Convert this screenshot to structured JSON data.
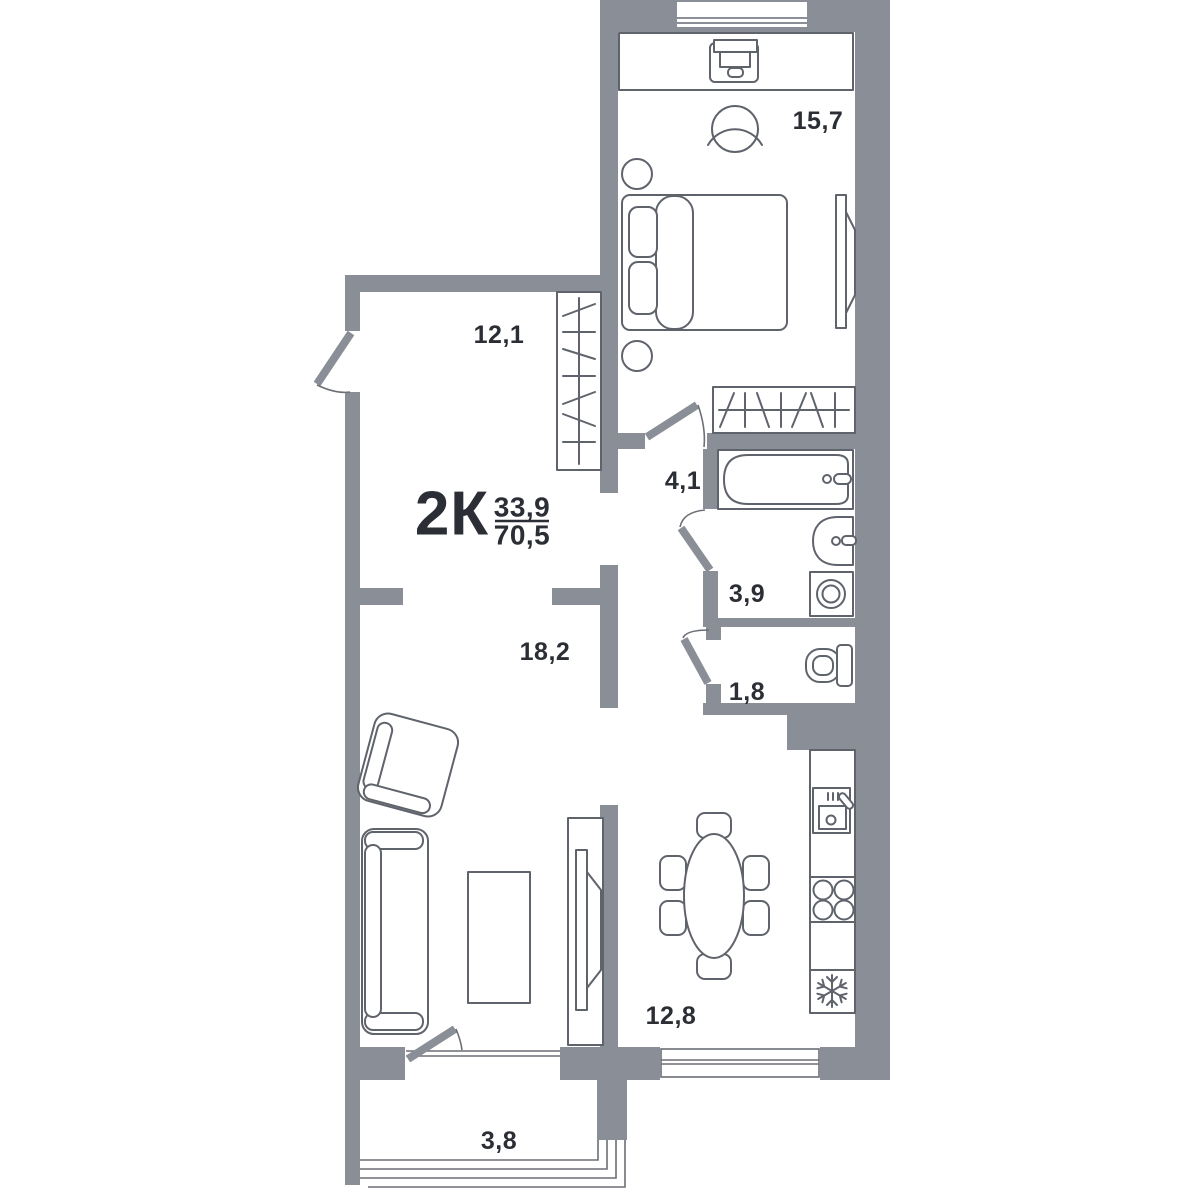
{
  "plan": {
    "title": "2К",
    "area_living": "33,9",
    "area_total": "70,5",
    "rooms": [
      {
        "name": "bedroom",
        "area": "15,7"
      },
      {
        "name": "hallway",
        "area": "12,1"
      },
      {
        "name": "corridor",
        "area": "4,1"
      },
      {
        "name": "bathroom",
        "area": "3,9"
      },
      {
        "name": "wc",
        "area": "1,8"
      },
      {
        "name": "living-room",
        "area": "18,2"
      },
      {
        "name": "kitchen",
        "area": "12,8"
      },
      {
        "name": "balcony",
        "area": "3,8"
      }
    ],
    "colors": {
      "wall": "#8A8E96",
      "furniture_stroke": "#5F636B",
      "thin_line": "#6B6F76",
      "label": "#2B2E34",
      "background": "#FFFFFF"
    }
  }
}
